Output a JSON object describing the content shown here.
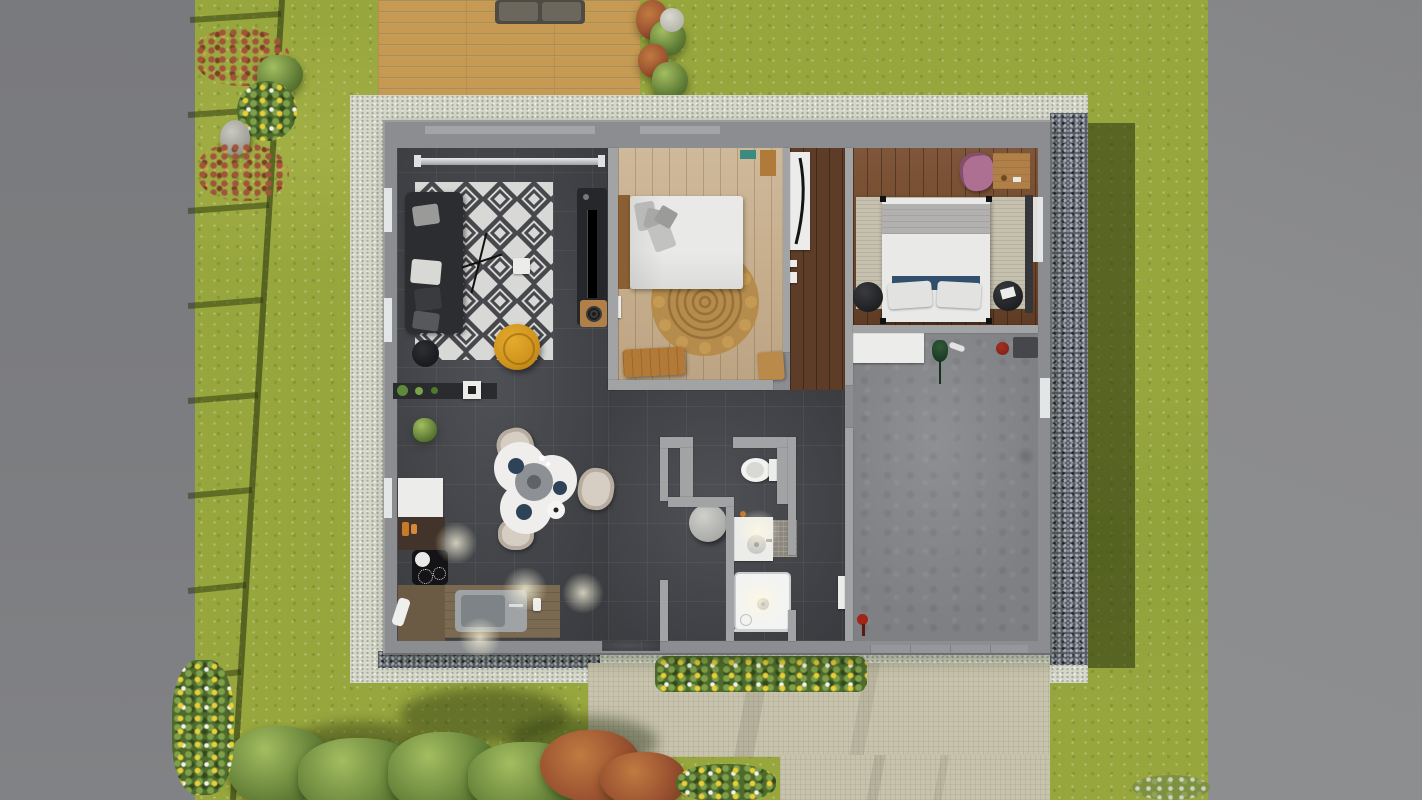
{
  "scene_type": "3d-top-down-floorplan-render",
  "labels": {
    "scene": "3D top-down rendering of a single-storey house with garden",
    "garden": "Lawn garden",
    "street_left": "Paved area (left)",
    "street_right": "Paved area (right)",
    "fence": "Garden fence shadow",
    "flower_bed_left": "Flower bed with shrubs and rock",
    "terrace": "Wooden terrace deck",
    "outdoor_sofa": "Outdoor sofa",
    "deck_flowers": "Terrace flower border",
    "apron": "Concrete apron around house",
    "gravel": "Gravel drainage strip",
    "house_shadow": "House shadow",
    "driveway": "Paved driveway and walkway",
    "flower_bed_front": "Front flower bed",
    "bushes": "Garden shrubs",
    "house": "House floor plan",
    "living_room": "Living room",
    "sofa": "Dark fabric sofa with cushions",
    "diamond_rug": "Black and white diamond rug",
    "coffee_table": "Small white coffee table",
    "floor_lamp": "Floor lamp",
    "pouf": "Yellow pouf",
    "side_table": "Round black side table",
    "tv_unit": "TV sideboard",
    "record_table": "Wooden side cabinet",
    "curtain_rod": "Window with curtain rod",
    "plant_shelf": "Wall shelf with plants and coffee machine",
    "kitchen": "Kitchen",
    "fridge": "Refrigerator",
    "upper_counter": "Kitchen counter with jars",
    "cooktop": "Black cooktop with pot",
    "lower_counter": "Kitchen counter",
    "sink_counter": "Counter with stainless sink",
    "kitchen_plant": "Potted plant",
    "dining_table": "White dining table with trays and plates",
    "dining_chair": "Beige dining chair",
    "bedroom_1": "Bedroom 1",
    "bed_1": "Double bed with white duvet",
    "jute_rug": "Round jute rug",
    "bench": "Wooden bench",
    "bedroom1_door": "Open wooden door",
    "hallway": "Hallway",
    "wardrobe_mirror": "Wardrobe with standing mirror",
    "bedroom_2": "Bedroom 2",
    "bed_2": "Double bed with grey blanket and blue pillows",
    "nightstand": "Round black nightstand",
    "desk": "Wooden desk",
    "pink_chair": "Pink chair",
    "beige_rug": "Beige area rug",
    "bathroom": "Bathroom",
    "wc": "Separate WC",
    "toilet": "Toilet",
    "washbasin": "Washbasin vanity",
    "bath_mat": "Bath mat",
    "shower": "Shower tray",
    "round_stool": "Round grey stool",
    "bath_door": "White interior door",
    "garage": "Garage",
    "storage_cabinet": "White storage cabinet",
    "garage_plant": "Green plant",
    "garage_mat": "Dark floor mat",
    "red_object": "Red canister",
    "floor_stain": "Concrete floor stain",
    "entry_door": "Entry door recess",
    "garage_door": "Garage door",
    "window": "Window"
  },
  "palette": {
    "lawn": "#98a63e",
    "road_left": "#7c7d80",
    "road_right": "#8b8c8e",
    "deck": "#c69a52",
    "apron": "#d6d8ca",
    "gravel": "#565a63",
    "pavement": "#c8c3ac",
    "wall": "#8c8d90",
    "wall_inner": "#a2a3a5",
    "floor_dark": "#45474c",
    "wood_light": "#c9b190",
    "wood_dark": "#74492c",
    "wood_hall": "#5e3d28",
    "concrete": "#7e8083",
    "rug_white": "#d8d8d6",
    "rug_black": "#47484c",
    "sofa": "#2c2d31",
    "pouf_yellow": "#d0931c",
    "jute": "#b68c4c",
    "bed_linen": "#e9e9e7",
    "blanket_grey": "#b2b1af",
    "pillow_navy": "#31506e",
    "rug_beige": "#c6c0af",
    "chair_pink": "#ad6f92",
    "chair_beige": "#d7cec3",
    "table_white": "#efeeec",
    "desk_wood": "#b08048",
    "teal_accent": "#3d8a80",
    "red_item": "#7c1f12",
    "shadow_green": "#24300d"
  }
}
